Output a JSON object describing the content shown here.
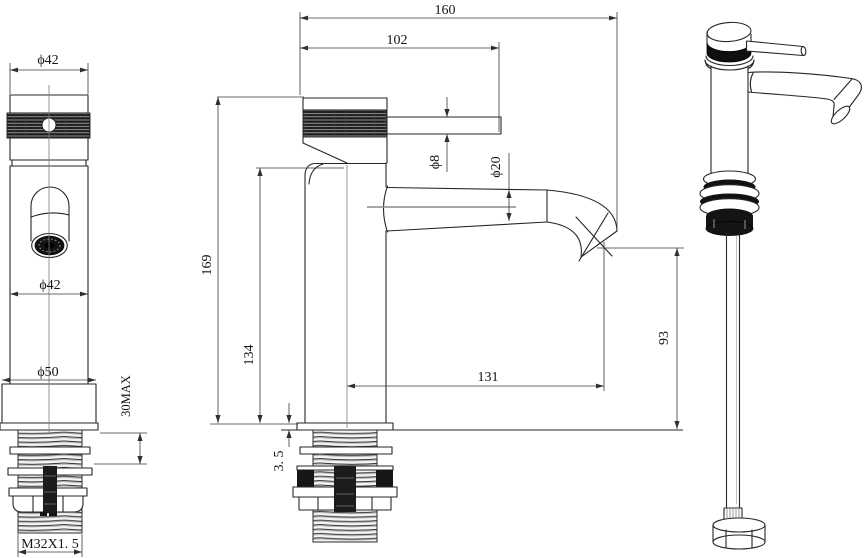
{
  "colors": {
    "background": "#ffffff",
    "object_line": "#262626",
    "dimension_line": "#3a3a3a",
    "dark_fill": "#161616",
    "centerline": "#8a8a8a"
  },
  "labels": {
    "front": {
      "cap_diameter": "ϕ42",
      "body_diameter": "ϕ42",
      "base_diameter": "ϕ50",
      "mount_thickness_max": "30MAX",
      "thread_spec": "M32X1. 5"
    },
    "side": {
      "overall_projection": "160",
      "handle_projection": "102",
      "overall_height": "169",
      "body_height": "134",
      "handle_diameter": "ϕ8",
      "spout_diameter": "ϕ20",
      "spout_projection": "131",
      "outlet_height": "93",
      "flange_thickness": "3. 5"
    }
  }
}
